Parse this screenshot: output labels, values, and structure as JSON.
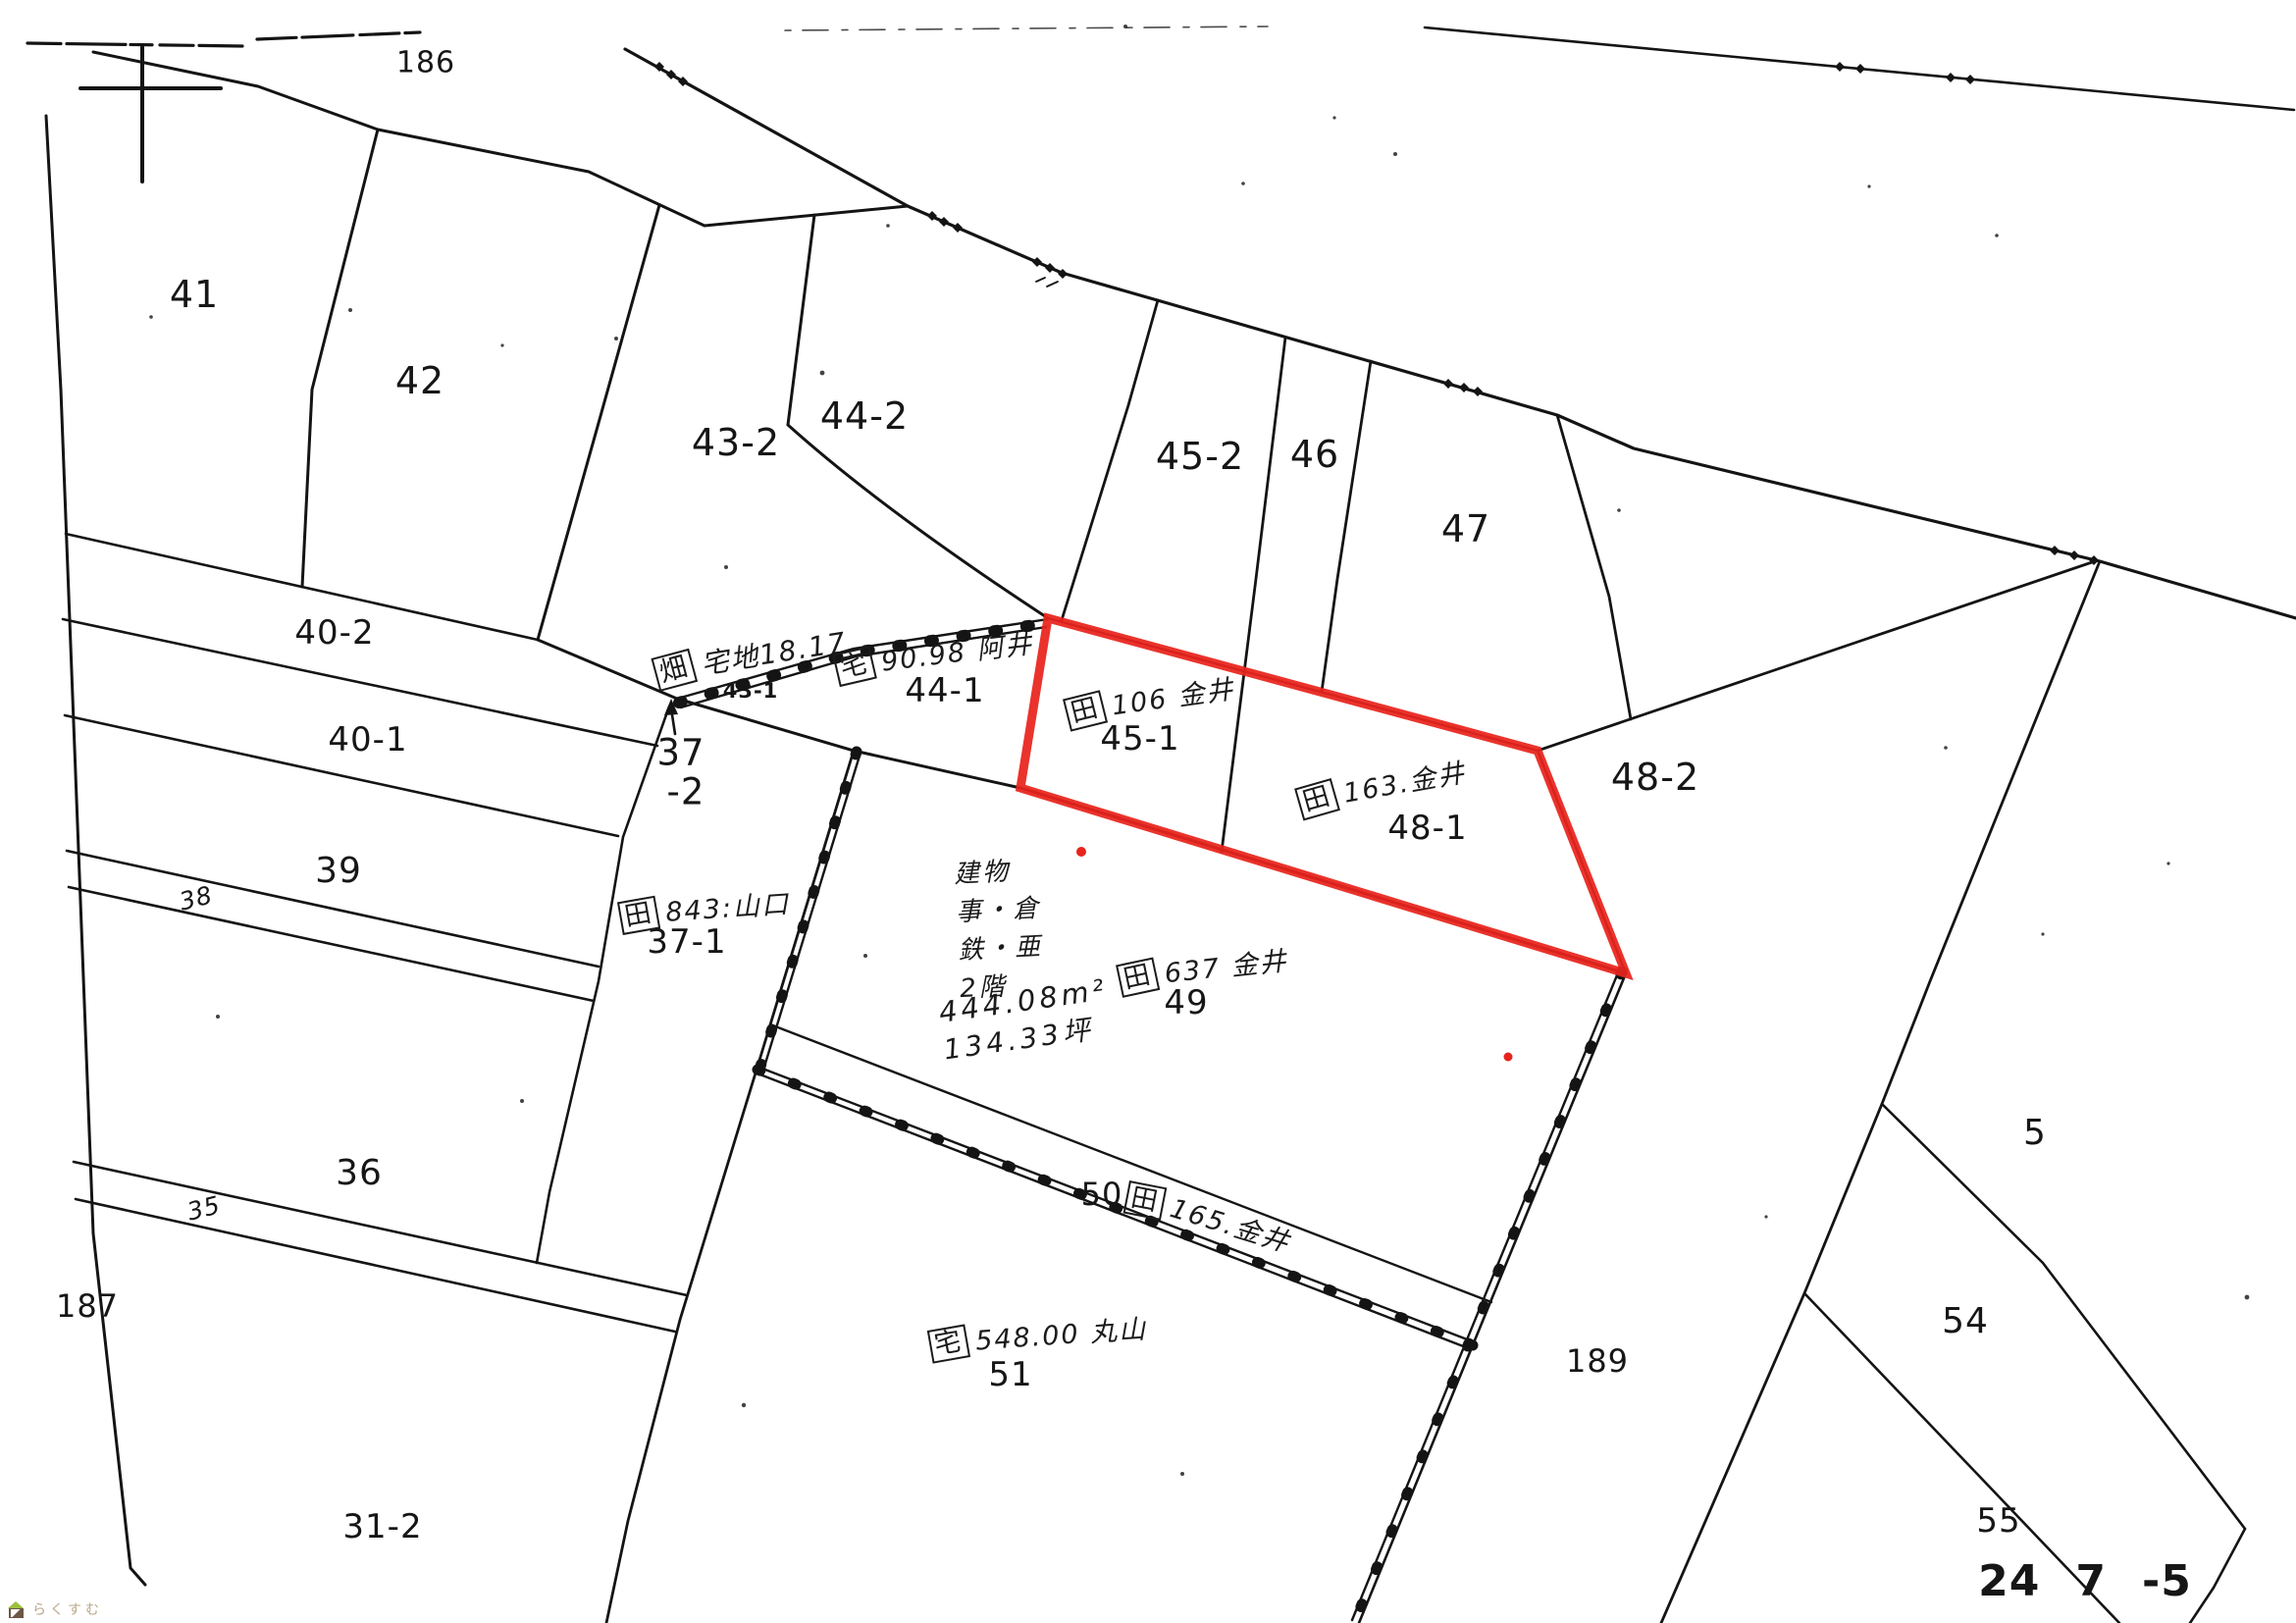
{
  "map": {
    "title": "cadastral-parcel-map",
    "colors": {
      "line": "#141414",
      "highlight": "#e8231c",
      "dot": "#e8231c",
      "watermark": "#b9a88c"
    },
    "regions": {
      "r186": "186",
      "r187": "187",
      "r189": "189"
    },
    "parcels": {
      "p41": "41",
      "p42": "42",
      "p43_2": "43-2",
      "p43_1": "43-1",
      "p44_2": "44-2",
      "p44_1": "44-1",
      "p45_2": "45-2",
      "p45_1": "45-1",
      "p46": "46",
      "p47": "47",
      "p48_2": "48-2",
      "p48_1": "48-1",
      "p40_2": "40-2",
      "p40_1": "40-1",
      "p39": "39",
      "p38": "38",
      "p37": "37",
      "p37_minor": "-2",
      "p37_1": "37-1",
      "p36": "36",
      "p35": "35",
      "p31_2": "31-2",
      "p49": "49",
      "p50": "50",
      "p51": "51",
      "p5": "5",
      "p54": "54",
      "p55": "55",
      "p24": "24",
      "p7": "7",
      "pm5": "-5"
    },
    "annotations": {
      "a43_1": {
        "mark": "畑",
        "text": "宅地18.17"
      },
      "a44_1": {
        "mark": "宅",
        "text": "90.98 阿井"
      },
      "a45_1": {
        "mark": "田",
        "text": "106 金井"
      },
      "a48_1": {
        "mark": "田",
        "text": "163.金井"
      },
      "a37_1": {
        "mark": "田",
        "text": "843:山口"
      },
      "a49": {
        "mark": "田",
        "text": "637 金井"
      },
      "a50": {
        "mark": "田",
        "text": "165.金井"
      },
      "a51": {
        "mark": "宅",
        "text": "548.00 丸山"
      }
    },
    "building_note": {
      "line1": "建物",
      "line2": "事・倉",
      "line3": "鉄・亜",
      "line4": "2階",
      "area_m2": "444.08m²",
      "area_tsubo": "134.33坪"
    },
    "watermark": "らくすむ"
  }
}
